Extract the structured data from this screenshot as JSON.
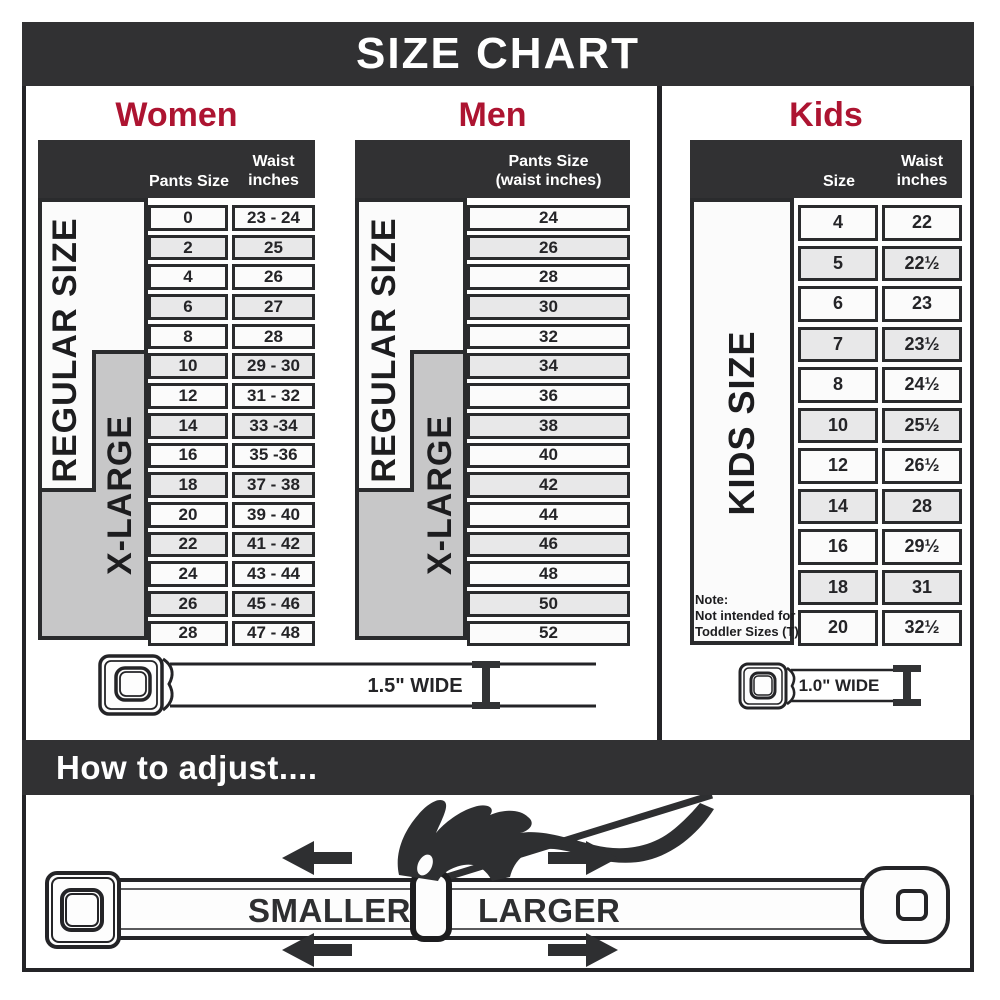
{
  "title": "SIZE CHART",
  "colors": {
    "dark_banner": "#313133",
    "heading_red": "#ad1431",
    "xlarge_gray": "#c7c7c8",
    "row_alt_gray": "#e8e8e9",
    "row_white": "#fbfbfb"
  },
  "sections": {
    "women": {
      "heading": "Women",
      "columns": {
        "col1": "Pants Size",
        "col2_line1": "Waist",
        "col2_line2": "inches"
      },
      "labels": {
        "regular": "REGULAR SIZE",
        "xlarge": "X-LARGE"
      },
      "rows": [
        {
          "size": "0",
          "waist": "23 - 24"
        },
        {
          "size": "2",
          "waist": "25"
        },
        {
          "size": "4",
          "waist": "26"
        },
        {
          "size": "6",
          "waist": "27"
        },
        {
          "size": "8",
          "waist": "28"
        },
        {
          "size": "10",
          "waist": "29 - 30"
        },
        {
          "size": "12",
          "waist": "31 - 32"
        },
        {
          "size": "14",
          "waist": "33 -34"
        },
        {
          "size": "16",
          "waist": "35 -36"
        },
        {
          "size": "18",
          "waist": "37 - 38"
        },
        {
          "size": "20",
          "waist": "39 - 40"
        },
        {
          "size": "22",
          "waist": "41 - 42"
        },
        {
          "size": "24",
          "waist": "43 - 44"
        },
        {
          "size": "26",
          "waist": "45 - 46"
        },
        {
          "size": "28",
          "waist": "47 - 48"
        }
      ]
    },
    "men": {
      "heading": "Men",
      "columns": {
        "col_line1": "Pants Size",
        "col_line2": "(waist inches)"
      },
      "labels": {
        "regular": "REGULAR SIZE",
        "xlarge": "X-LARGE"
      },
      "rows": [
        "24",
        "26",
        "28",
        "30",
        "32",
        "34",
        "36",
        "38",
        "40",
        "42",
        "44",
        "46",
        "48",
        "50",
        "52"
      ]
    },
    "kids": {
      "heading": "Kids",
      "columns": {
        "col1": "Size",
        "col2_line1": "Waist",
        "col2_line2": "inches"
      },
      "label": "KIDS SIZE",
      "note": [
        "Note:",
        "Not intended for",
        "Toddler Sizes (T)"
      ],
      "rows": [
        {
          "size": "4",
          "waist": "22"
        },
        {
          "size": "5",
          "waist": "22½"
        },
        {
          "size": "6",
          "waist": "23"
        },
        {
          "size": "7",
          "waist": "23½"
        },
        {
          "size": "8",
          "waist": "24½"
        },
        {
          "size": "10",
          "waist": "25½"
        },
        {
          "size": "12",
          "waist": "26½"
        },
        {
          "size": "14",
          "waist": "28"
        },
        {
          "size": "16",
          "waist": "29½"
        },
        {
          "size": "18",
          "waist": "31"
        },
        {
          "size": "20",
          "waist": "32½"
        }
      ]
    }
  },
  "belts": {
    "adult_label": "1.5\" WIDE",
    "kids_label": "1.0\" WIDE"
  },
  "adjust": {
    "heading": "How to adjust....",
    "smaller": "SMALLER",
    "larger": "LARGER"
  }
}
